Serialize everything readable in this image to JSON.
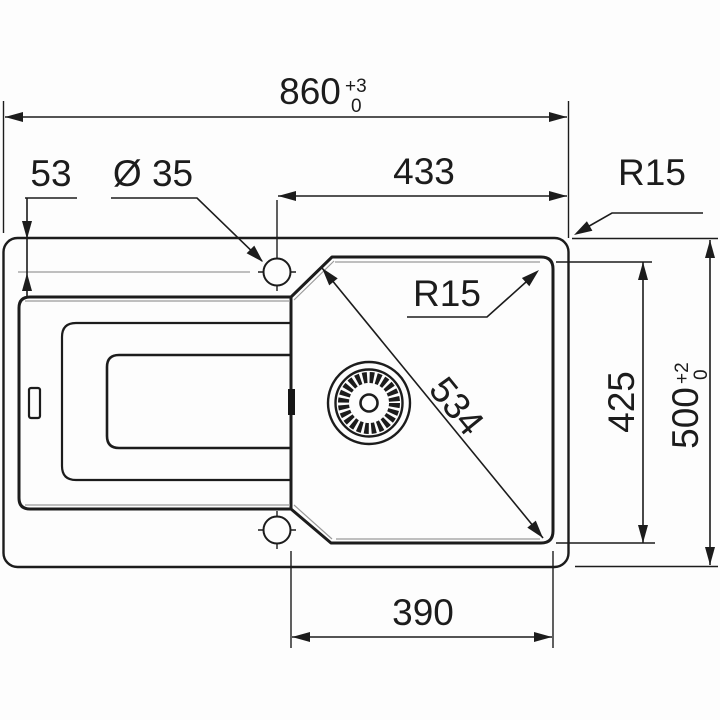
{
  "drawing": {
    "title": "sink-installation-dimension-drawing",
    "units": "mm",
    "dimensions": {
      "overall_width": {
        "value": "860",
        "tol_plus": "+3",
        "tol_minus": "0"
      },
      "faucet_hole_offset": "53",
      "faucet_hole_diameter": "Ø 35",
      "faucet_to_right_edge": "433",
      "outer_corner_radius": "R15",
      "bowl_corner_radius": "R15",
      "bowl_diagonal": "534",
      "bowl_depth": "425",
      "overall_depth": {
        "value": "500",
        "tol_plus": "+2",
        "tol_minus": "0"
      },
      "bowl_width": "390"
    },
    "colors": {
      "line": "#1c1c1c",
      "thin_line": "#9a9a9a",
      "background": "#fdfdfd"
    }
  }
}
